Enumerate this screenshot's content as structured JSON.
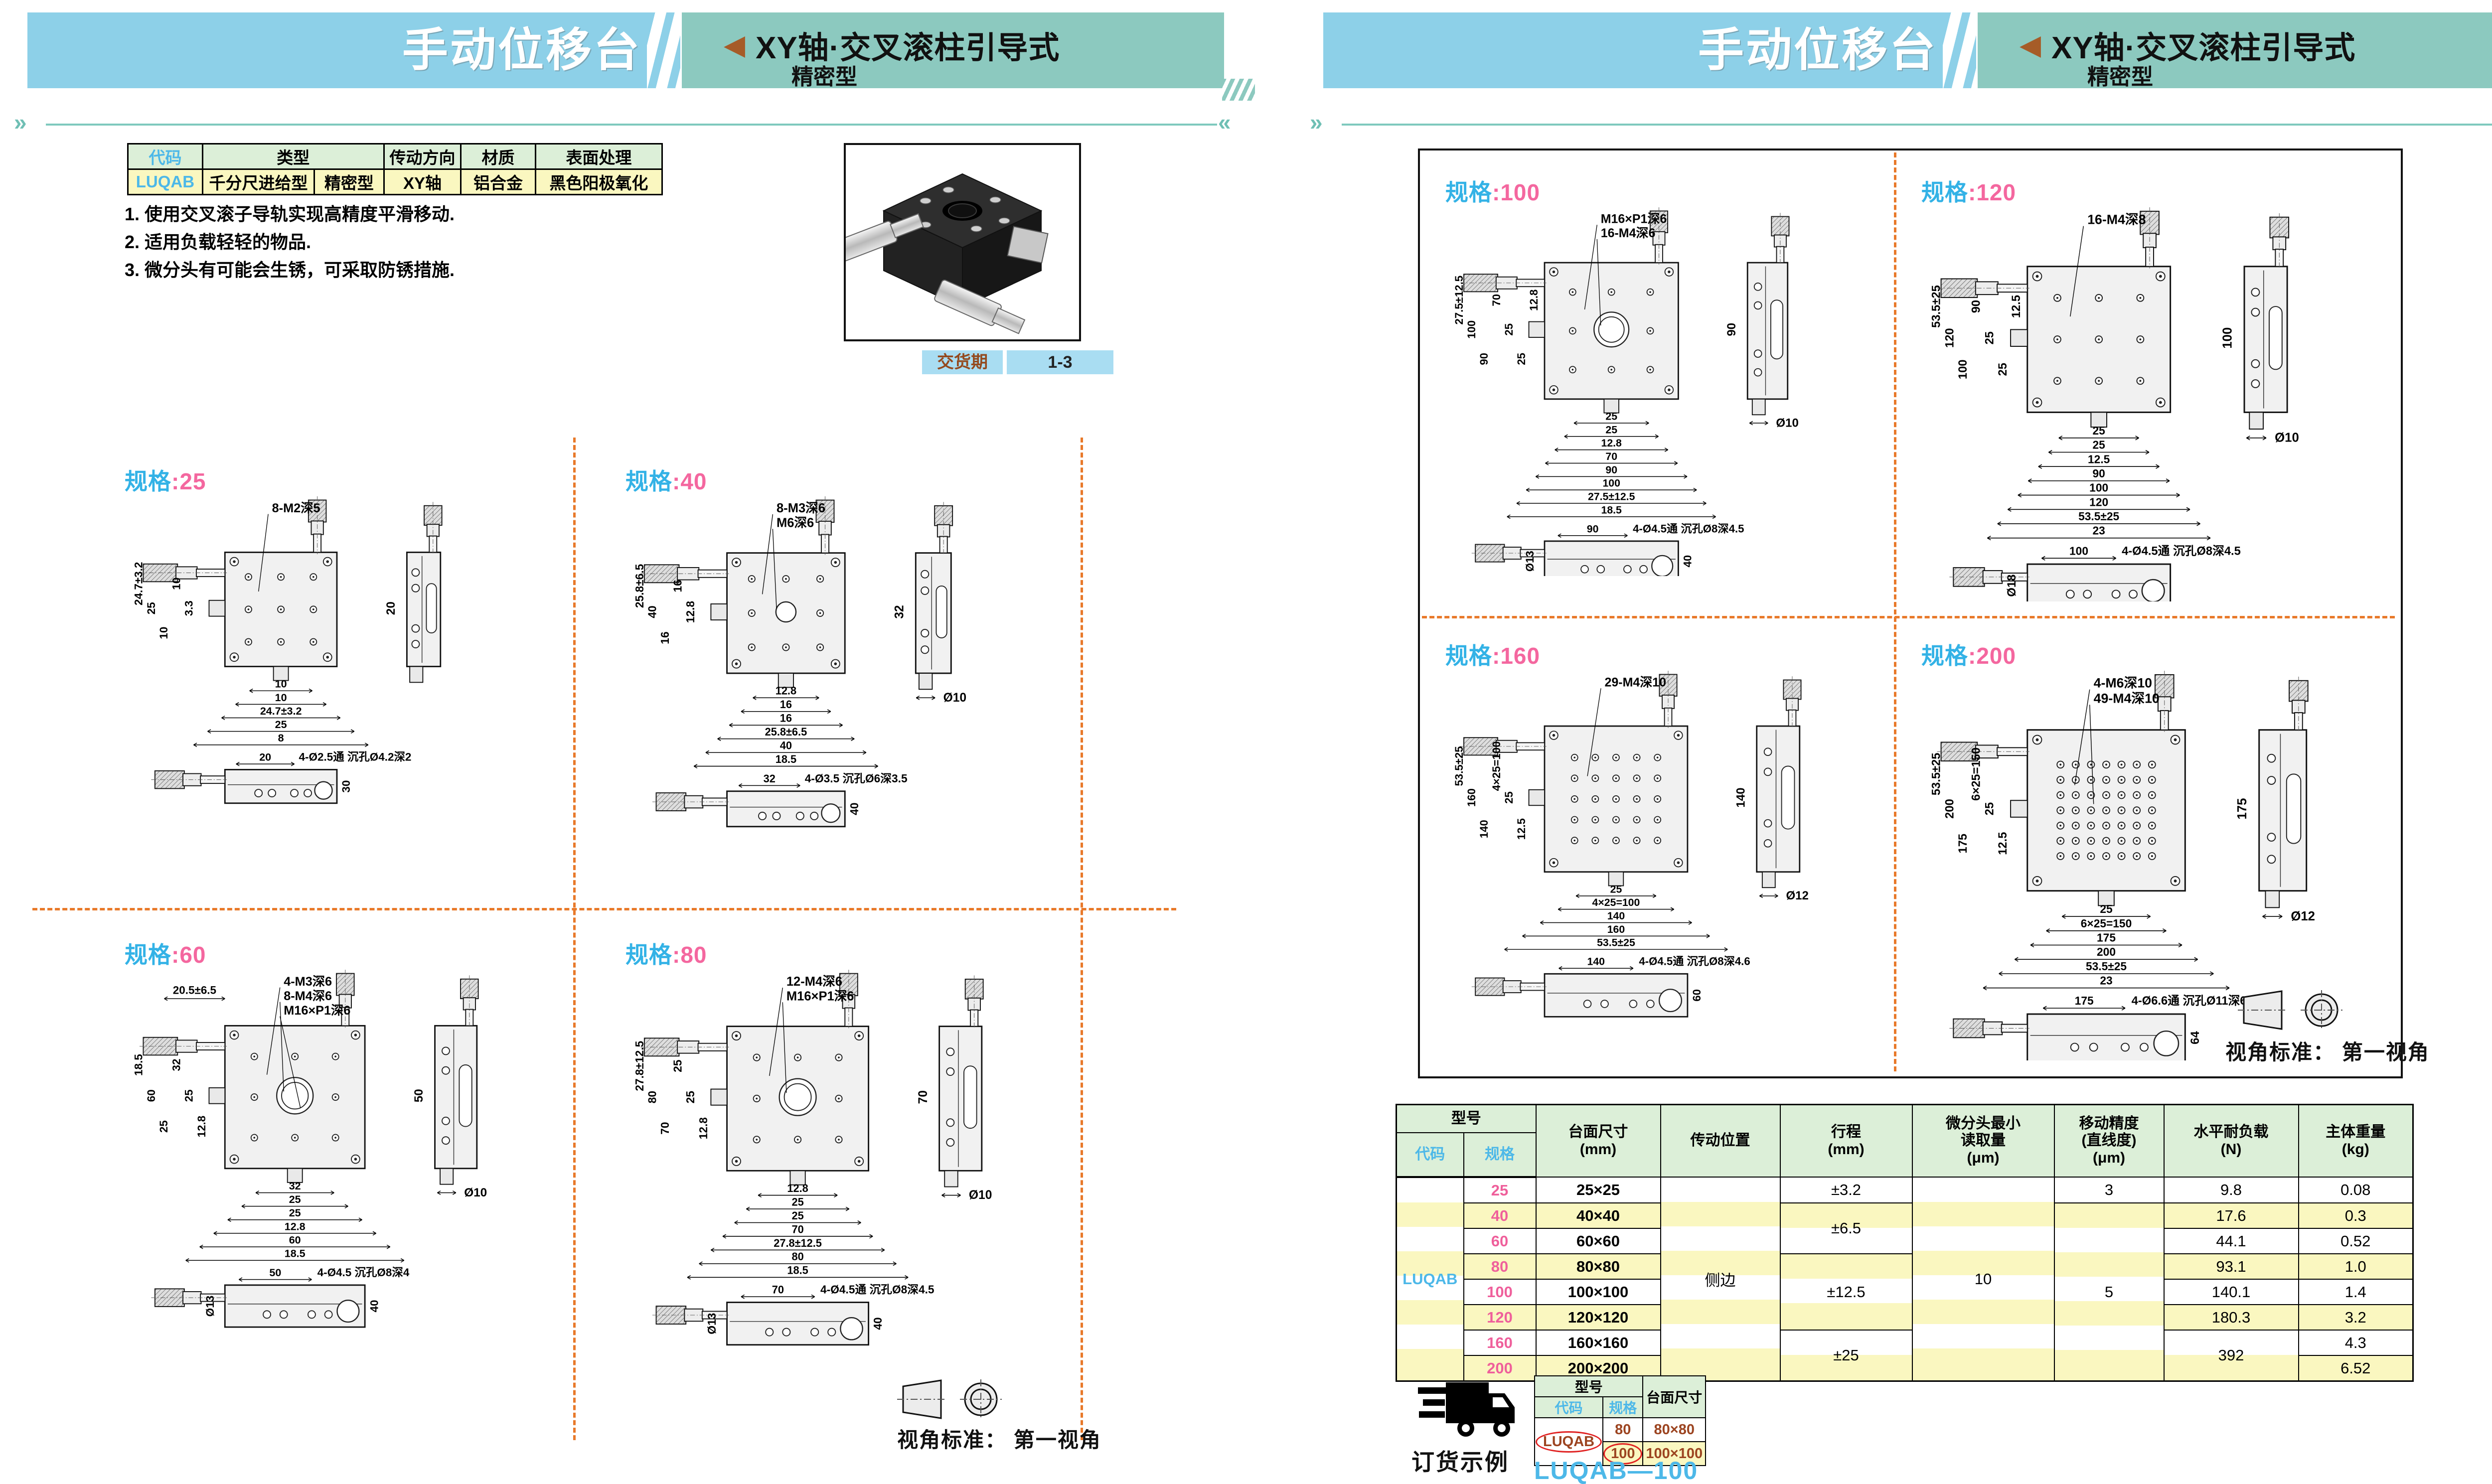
{
  "header": {
    "title": "手动位移台",
    "arrow_icon": "left-triangle",
    "category": "XY轴·交叉滚柱引导式",
    "subcategory": "精密型"
  },
  "info_table": {
    "headers": {
      "code": "代码",
      "type": "类型",
      "direction": "传动方向",
      "material": "材质",
      "surface": "表面处理"
    },
    "row": {
      "code": "LUQAB",
      "type_main": "千分尺进给型",
      "type_sub": "精密型",
      "direction": "XY轴",
      "material": "铝合金",
      "surface": "黑色阳极氧化"
    }
  },
  "notes": [
    "1. 使用交叉滚子导轨实现高精度平滑移动.",
    "2. 适用负载轻轻的物品.",
    "3. 微分头有可能会生锈，可采取防锈措施."
  ],
  "delivery": {
    "label": "交货期",
    "value": "1-3"
  },
  "view_standard": "视角标准： 第一视角",
  "panels": [
    {
      "label": {
        "prefix": "规格",
        "value": "25"
      },
      "callouts": [
        "8-M2深5"
      ],
      "dims_left": [
        "24.7±3.2",
        "25",
        "10",
        "10",
        "3.3"
      ],
      "dims_bottom": [
        "10",
        "10",
        "24.7±3.2",
        "25",
        "8"
      ],
      "side_dims": [
        "20"
      ],
      "bottom_view": {
        "width_dim": "20",
        "height_dim": "30",
        "left_dim": "",
        "callout": "4-Ø2.5通 沉孔Ø4.2深2"
      }
    },
    {
      "label": {
        "prefix": "规格",
        "value": "40"
      },
      "callouts": [
        "8-M3深6",
        "M6深6"
      ],
      "dims_left": [
        "25.8±6.5",
        "40",
        "16",
        "16",
        "12.8"
      ],
      "dims_bottom": [
        "12.8",
        "16",
        "16",
        "25.8±6.5",
        "40",
        "18.5"
      ],
      "side_dims": [
        "32",
        "Ø10"
      ],
      "bottom_view": {
        "width_dim": "32",
        "height_dim": "40",
        "left_dim": "",
        "callout": "4-Ø3.5 沉孔Ø6深3.5"
      }
    },
    {
      "label": {
        "prefix": "规格",
        "value": "60"
      },
      "callouts": [
        "4-M3深6",
        "8-M4深6",
        "M16×P1深6"
      ],
      "dim_top": "20.5±6.5",
      "dims_left": [
        "18.5",
        "60",
        "25",
        "32",
        "25",
        "12.8"
      ],
      "dims_bottom": [
        "32",
        "25",
        "25",
        "12.8",
        "60",
        "18.5"
      ],
      "side_dims": [
        "50",
        "Ø10"
      ],
      "bottom_view": {
        "width_dim": "50",
        "height_dim": "40",
        "left_dim": "Ø13",
        "callout": "4-Ø4.5 沉孔Ø8深4"
      }
    },
    {
      "label": {
        "prefix": "规格",
        "value": "80"
      },
      "callouts": [
        "12-M4深6",
        "M16×P1深6"
      ],
      "dims_left": [
        "27.8±12.5",
        "80",
        "70",
        "25",
        "25",
        "12.8"
      ],
      "dims_bottom": [
        "12.8",
        "25",
        "25",
        "70",
        "27.8±12.5",
        "80",
        "18.5"
      ],
      "side_dims": [
        "70",
        "Ø10"
      ],
      "bottom_view": {
        "width_dim": "70",
        "height_dim": "40",
        "left_dim": "Ø13",
        "callout": "4-Ø4.5通 沉孔Ø8深4.5"
      }
    },
    {
      "label": {
        "prefix": "规格",
        "value": "100"
      },
      "callouts": [
        "M16×P1深6",
        "16-M4深6"
      ],
      "dims_left": [
        "27.5±12.5",
        "100",
        "90",
        "70",
        "25",
        "25",
        "12.8"
      ],
      "dims_bottom": [
        "25",
        "25",
        "12.8",
        "70",
        "90",
        "100",
        "27.5±12.5",
        "18.5"
      ],
      "side_dims": [
        "90",
        "Ø10"
      ],
      "bottom_view": {
        "width_dim": "90",
        "height_dim": "40",
        "left_dim": "Ø13",
        "callout": "4-Ø4.5通 沉孔Ø8深4.5"
      }
    },
    {
      "label": {
        "prefix": "规格",
        "value": "120"
      },
      "callouts": [
        "16-M4深8"
      ],
      "dims_left": [
        "53.5±25",
        "120",
        "100",
        "90",
        "25",
        "25",
        "12.5"
      ],
      "dims_bottom": [
        "25",
        "25",
        "12.5",
        "90",
        "100",
        "120",
        "53.5±25",
        "23"
      ],
      "side_dims": [
        "100",
        "Ø10"
      ],
      "bottom_view": {
        "width_dim": "100",
        "height_dim": "",
        "left_dim": "Ø18",
        "callout": "4-Ø4.5通 沉孔Ø8深4.5"
      }
    },
    {
      "label": {
        "prefix": "规格",
        "value": "160"
      },
      "callouts": [
        "29-M4深10"
      ],
      "dims_left": [
        "53.5±25",
        "160",
        "140",
        "4×25=100",
        "25",
        "12.5"
      ],
      "dims_bottom": [
        "25",
        "4×25=100",
        "140",
        "160",
        "53.5±25"
      ],
      "side_dims": [
        "140",
        "Ø12"
      ],
      "bottom_view": {
        "width_dim": "140",
        "height_dim": "60",
        "left_dim": "",
        "callout": "4-Ø4.5通 沉孔Ø8深4.6"
      }
    },
    {
      "label": {
        "prefix": "规格",
        "value": "200"
      },
      "callouts": [
        "4-M6深10",
        "49-M4深10"
      ],
      "dims_left": [
        "53.5±25",
        "200",
        "175",
        "6×25=150",
        "25",
        "12.5"
      ],
      "dims_bottom": [
        "25",
        "6×25=150",
        "175",
        "200",
        "53.5±25",
        "23"
      ],
      "side_dims": [
        "175",
        "Ø12"
      ],
      "bottom_view": {
        "width_dim": "175",
        "height_dim": "64",
        "left_dim": "",
        "callout": "4-Ø6.6通 沉孔Ø11深6.8"
      }
    }
  ],
  "spec_table": {
    "model_header": "型号",
    "col_headers": {
      "code": "代码",
      "spec": "规格",
      "size": "台面尺寸\n(mm)",
      "drive": "传动位置",
      "travel": "行程\n(mm)",
      "reading": "微分头最小\n读取量\n(μm)",
      "accuracy": "移动精度\n(直线度)\n(μm)",
      "load": "水平耐负载\n(N)",
      "weight": "主体重量\n(kg)"
    },
    "code": "LUQAB",
    "drive_position": "侧边",
    "reading_value": "10",
    "travel": {
      "t25": "±3.2",
      "t40_60": "±6.5",
      "t80_120": "±12.5",
      "t160_200": "±25"
    },
    "accuracy": {
      "a25": "3",
      "a40_200": "5"
    },
    "load_merged_160_200": "392",
    "rows": [
      {
        "spec": "25",
        "size": "25×25",
        "load": "9.8",
        "weight": "0.08"
      },
      {
        "spec": "40",
        "size": "40×40",
        "load": "17.6",
        "weight": "0.3"
      },
      {
        "spec": "60",
        "size": "60×60",
        "load": "44.1",
        "weight": "0.52"
      },
      {
        "spec": "80",
        "size": "80×80",
        "load": "93.1",
        "weight": "1.0"
      },
      {
        "spec": "100",
        "size": "100×100",
        "load": "140.1",
        "weight": "1.4"
      },
      {
        "spec": "120",
        "size": "120×120",
        "load": "180.3",
        "weight": "3.2"
      },
      {
        "spec": "160",
        "size": "160×160",
        "load": "",
        "weight": "4.3"
      },
      {
        "spec": "200",
        "size": "200×200",
        "load": "",
        "weight": "6.52"
      }
    ]
  },
  "order_example": {
    "truck_icon": "delivery-truck",
    "title": "订货示例",
    "model_header": "型号",
    "code_header": "代码",
    "spec_header": "规格",
    "size_header": "台面尺寸",
    "code": "LUQAB",
    "rows": [
      {
        "spec": "80",
        "size": "80×80"
      },
      {
        "spec": "100",
        "size": "100×100"
      }
    ],
    "result": "LUQAB—100"
  },
  "colors": {
    "band_blue": "#8dd0e8",
    "band_teal": "#8cc9bf",
    "table_header_green": "#dcefd8",
    "row_yellow": "#faf7c0",
    "code_blue": "#4db8e8",
    "spec_pink": "#ef5f9b",
    "divider_orange": "#e8792a",
    "arrow_brown": "#a65c28",
    "order_value_brown": "#9c4420",
    "highlight_red": "#e02222"
  }
}
